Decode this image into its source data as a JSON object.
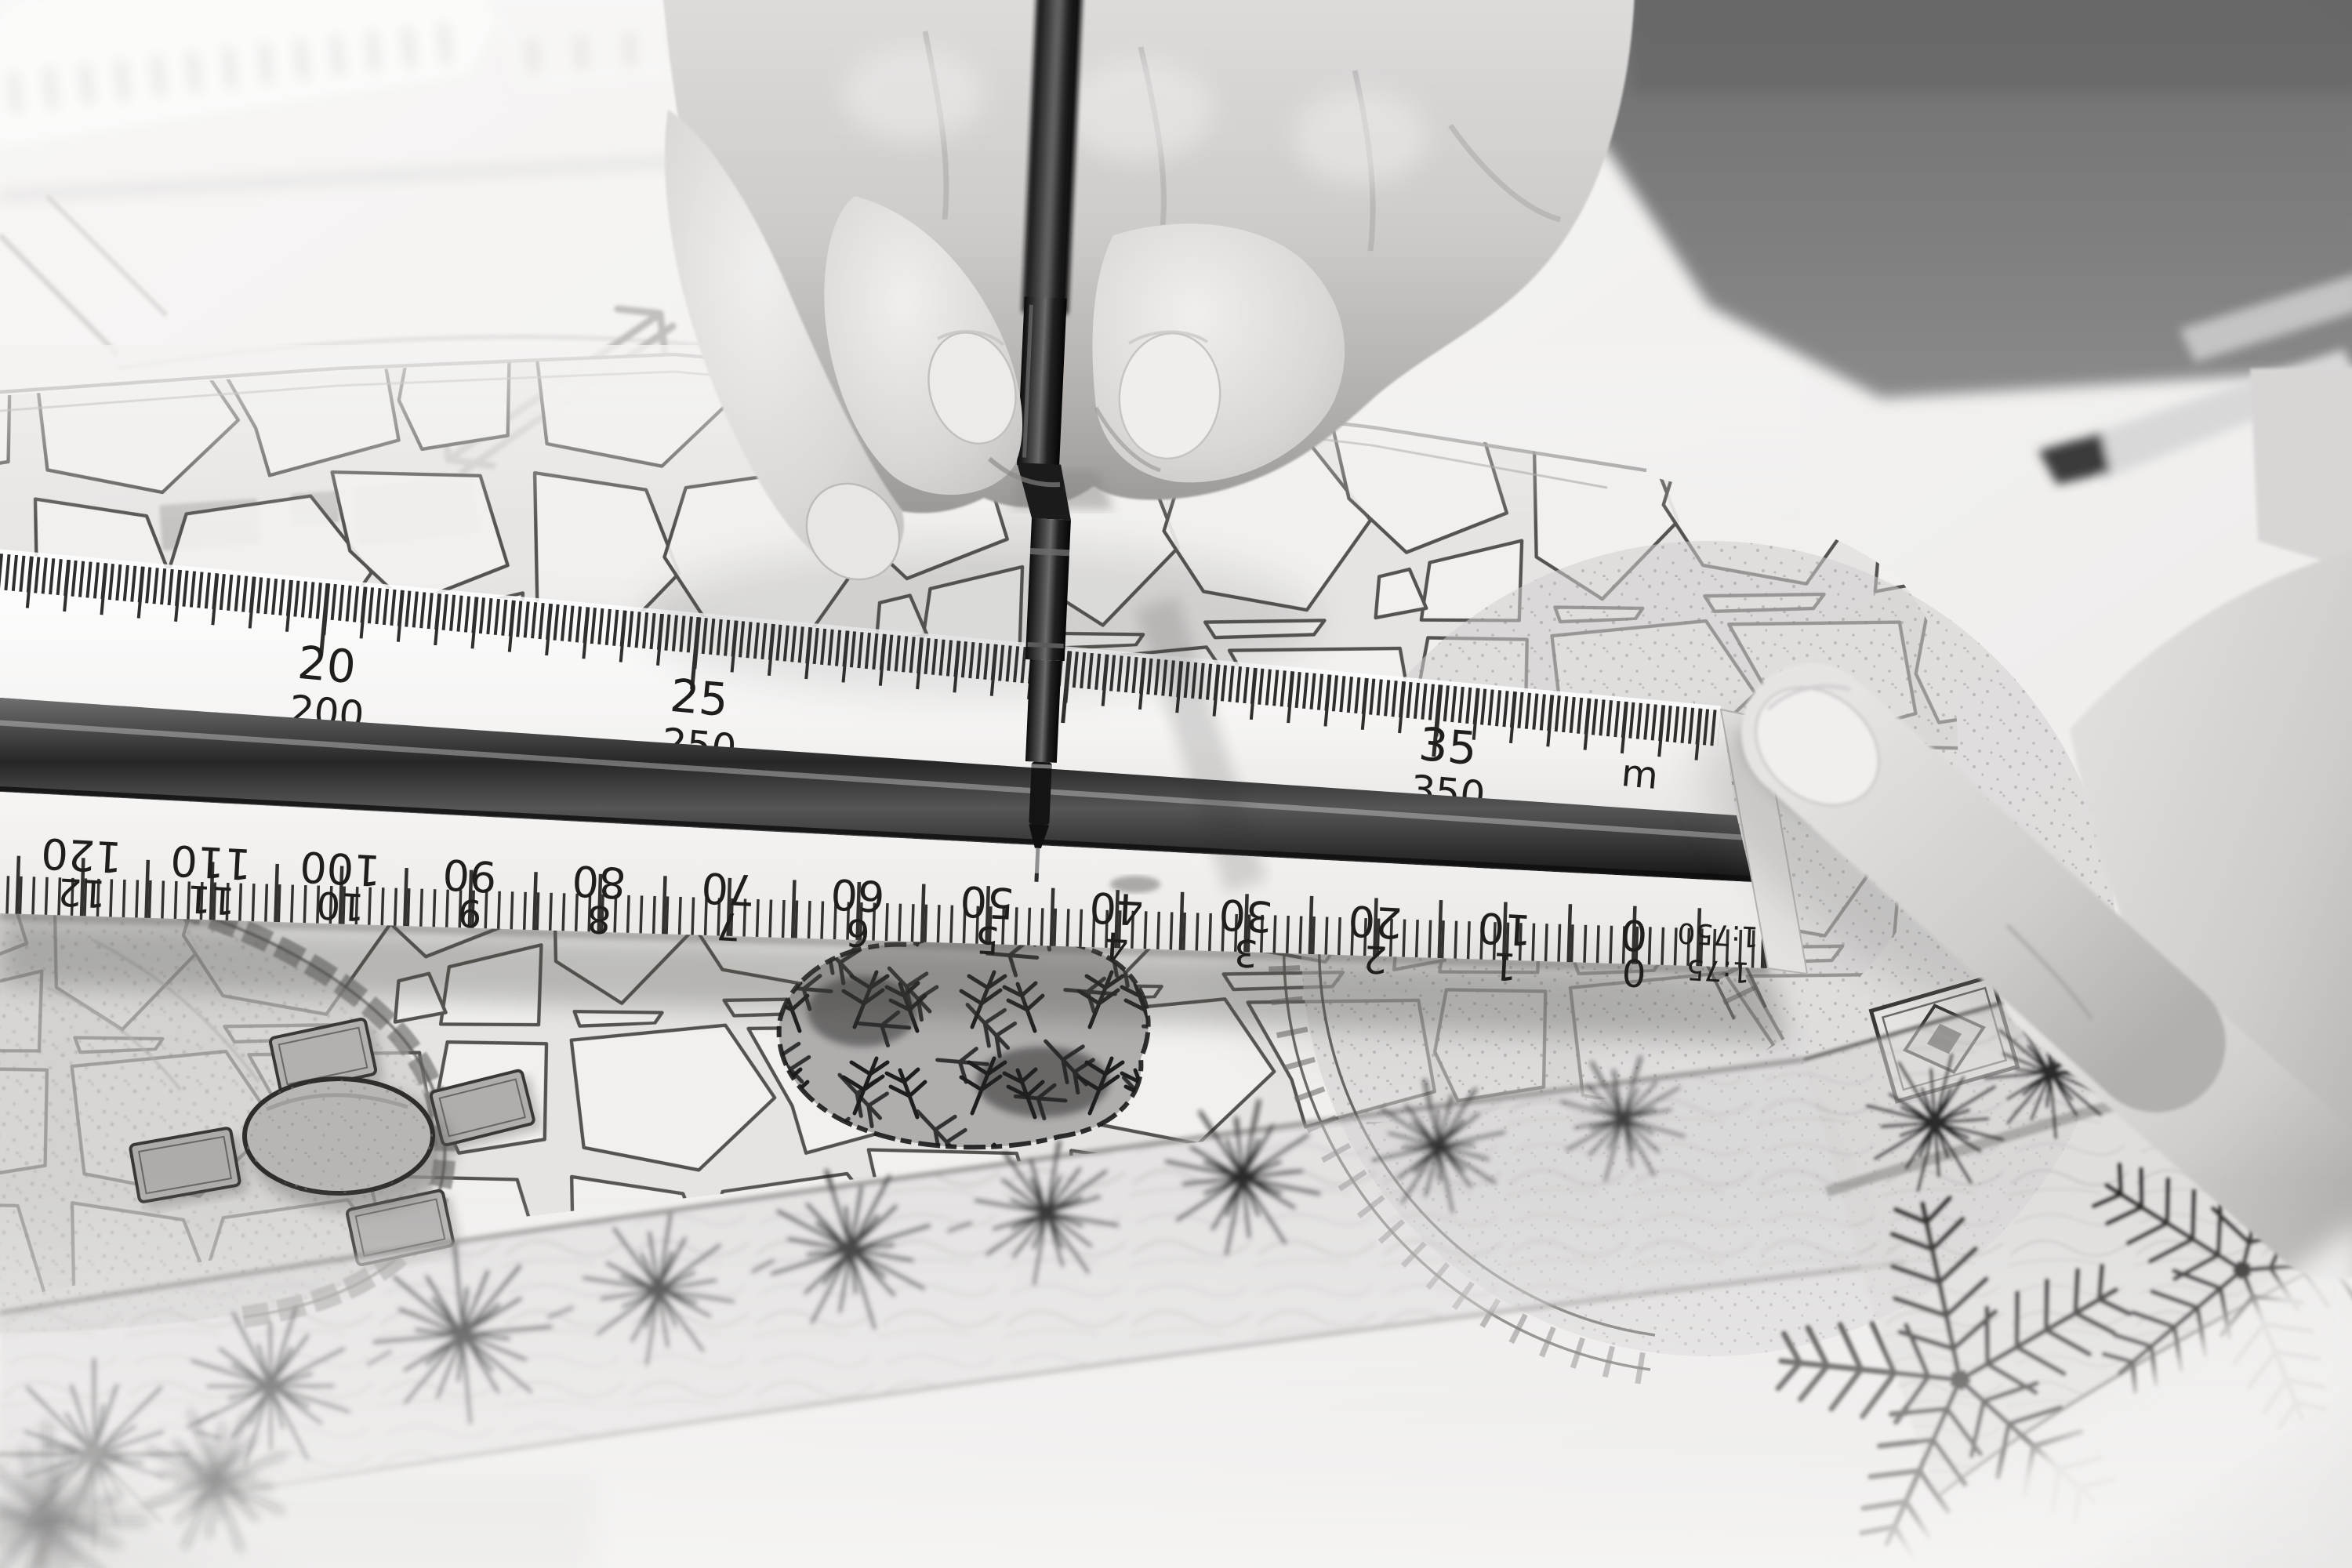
{
  "ruler": {
    "top_scale": {
      "labels": [
        {
          "upper": "20",
          "lower": "200"
        },
        {
          "upper": "25",
          "lower": "250"
        },
        {
          "upper": "35",
          "lower": "350"
        }
      ],
      "unit_stacked": [
        "m",
        "m"
      ]
    },
    "front_scale": {
      "pairs": [
        [
          "120",
          "12"
        ],
        [
          "110",
          "11"
        ],
        [
          "100",
          "10"
        ],
        [
          "90",
          "9"
        ],
        [
          "80",
          "8"
        ],
        [
          "70",
          "7"
        ],
        [
          "60",
          "6"
        ],
        [
          "50",
          "5"
        ],
        [
          "40",
          "4"
        ],
        [
          "30",
          "3"
        ],
        [
          "20",
          "2"
        ],
        [
          "10",
          "1"
        ],
        [
          "0",
          "0"
        ]
      ],
      "ratios": [
        "1:750",
        "1:75"
      ]
    }
  },
  "colors": {
    "paper": "#f2f1f0",
    "ink": "#1f1e1d",
    "ruler_face": "#fafaf9",
    "ruler_groove": "#2e2e2e",
    "skin_light": "#e7e5e4",
    "skin_shadow": "#a8a6a5",
    "background_dark": "#7a7a7a"
  }
}
